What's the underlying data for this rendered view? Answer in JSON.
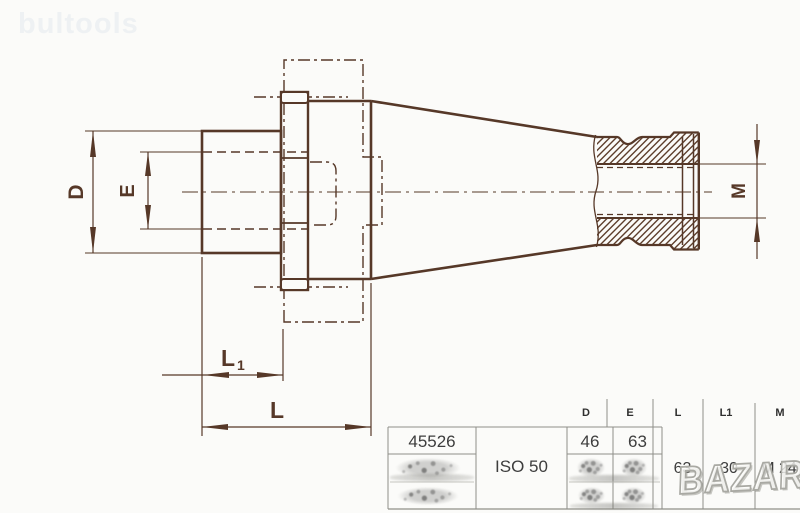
{
  "watermarks": {
    "top_left": "bultools",
    "bottom_right": "BAZAR"
  },
  "drawing": {
    "labels": {
      "d": "D",
      "e": "E",
      "m": "M",
      "l": "L",
      "l1_base": "L",
      "l1_sub": "1"
    }
  },
  "table": {
    "headers": [
      "D",
      "E",
      "L",
      "L1",
      "M"
    ],
    "order_number": "45526",
    "taper": "ISO 50",
    "values": {
      "d": "46",
      "e": "63",
      "l": "63",
      "l1": "30",
      "m": "M 24"
    }
  },
  "colors": {
    "drawing_ink": "#563828",
    "table_line": "#8f8f89",
    "table_text": "#3d3d3d",
    "watermark_light": "#eef1f3",
    "watermark_gray": "#a9a9a3"
  }
}
